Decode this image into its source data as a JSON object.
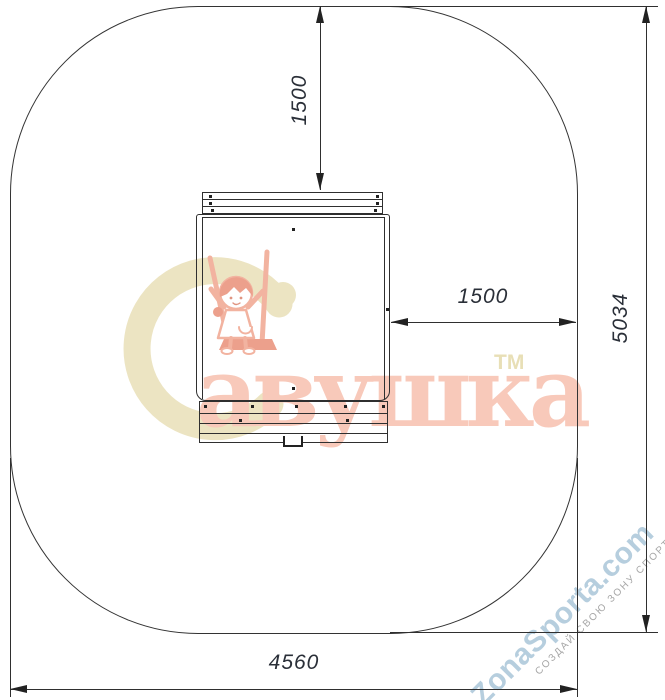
{
  "drawing": {
    "dim_top_offset": "1500",
    "dim_right_offset": "1500",
    "dim_total_height": "5034",
    "dim_total_width": "4560",
    "line_color": "#2f2f2f",
    "dim_text_color": "#2a2f38"
  },
  "brand": {
    "name": "Савушка",
    "word_suffix": "авушка",
    "trademark": "ТМ",
    "letter_color": "#f8c9ba",
    "initial_color": "#ece4c2",
    "tm_color": "#e8dfb6",
    "illustration": "girl-on-swing"
  },
  "watermark": {
    "site": "ZonaSporta.com",
    "slogan": "СОЗДАЙ СВОЮ ЗОНУ СПОРТА",
    "site_color": "#b6cede",
    "slogan_color": "#a6a6a6"
  }
}
